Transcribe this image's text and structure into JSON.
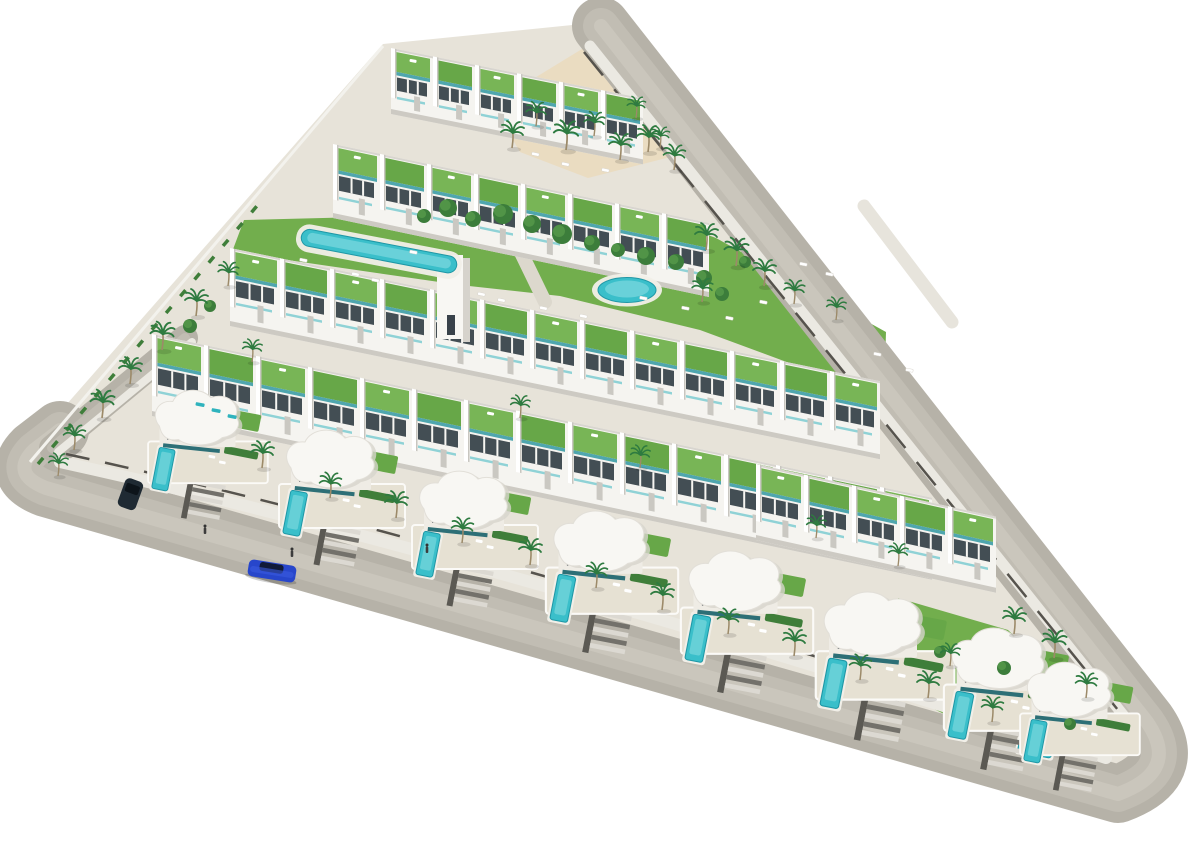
{
  "meta": {
    "width": 1204,
    "height": 853,
    "view": "aerial-3d-render-residential-development"
  },
  "palette": {
    "bg": "#ffffff",
    "ground": "#e7e3d9",
    "road": "#b6b2a8",
    "roadLight": "#c1bdb3",
    "roadLighter": "#cac6bc",
    "sidewalk": "#ebe9e2",
    "curb": "#56534d",
    "lawn": "#72ae4d",
    "lawnDark": "#5d9a40",
    "sand": "#eadcc1",
    "bldg": "#f5f4f0",
    "bldgShade": "#d8d5cf",
    "bldgShadow": "#cdcac3",
    "roofA": "#67a748",
    "roofB": "#78b556",
    "teal": "#4fa6ae",
    "tealLight": "#8fd2d6",
    "window": "#434e54",
    "pool": "#3abfca",
    "poolLight": "#79d7dd",
    "poolDark": "#1f97a6",
    "deck": "#f1efe8",
    "hedge": "#3f7e3a",
    "palm": "#2e7b40",
    "trunk": "#9c8a69",
    "pergola": "#4a5146",
    "person": "#333333"
  },
  "site": {
    "ground": [
      [
        383,
        44
      ],
      [
        602,
        22
      ],
      [
        1168,
        738
      ],
      [
        1150,
        788
      ],
      [
        1104,
        806
      ],
      [
        40,
        500
      ],
      [
        16,
        462
      ]
    ],
    "left_wall": {
      "x1": 30,
      "y1": 462,
      "x2": 383,
      "y2": 46
    },
    "left_hedge": {
      "x1": 38,
      "y1": 464,
      "x2": 262,
      "y2": 200
    }
  },
  "sand": [
    [
      492,
      104
    ],
    [
      600,
      38
    ],
    [
      690,
      152
    ],
    [
      588,
      178
    ],
    [
      520,
      152
    ]
  ],
  "lawns": [
    [
      [
        244,
        220
      ],
      [
        640,
        210
      ],
      [
        716,
        238
      ],
      [
        886,
        332
      ],
      [
        884,
        398
      ],
      [
        700,
        330
      ],
      [
        560,
        296
      ],
      [
        460,
        285
      ],
      [
        232,
        252
      ]
    ],
    [
      [
        898,
        598
      ],
      [
        1008,
        630
      ],
      [
        1102,
        722
      ],
      [
        1044,
        764
      ],
      [
        916,
        700
      ]
    ]
  ],
  "lawn_patches": [
    [
      [
        420,
        215
      ],
      [
        560,
        230
      ],
      [
        640,
        262
      ],
      [
        560,
        260
      ],
      [
        470,
        240
      ]
    ]
  ],
  "walkways": [
    {
      "x1": 513,
      "y1": 236,
      "x2": 545,
      "y2": 302,
      "w": 14,
      "color": "#dcd8cd"
    },
    {
      "x1": 864,
      "y1": 206,
      "x2": 952,
      "y2": 322,
      "w": 13,
      "color": "#e7e4dc"
    },
    {
      "x1": 622,
      "y1": 92,
      "x2": 702,
      "y2": 190,
      "w": 11,
      "color": "#4a5146"
    }
  ],
  "roads": {
    "main": {
      "d": "M 601,26 L 1147,722 Q 1181,771 1118,794 L 46,488 Q 10,474 34,450 L 60,430",
      "w": 58
    },
    "stub": {
      "d": "M 52,448 L 185,338",
      "w": 26
    },
    "streaks": [
      36,
      14
    ],
    "sidewalks": [
      {
        "d": "M 60,462 C 360,528 730,636 1106,758",
        "w": 12
      },
      {
        "d": "M 590,46 L 1124,716",
        "w": 11
      },
      {
        "d": "M 58,452 L 192,342",
        "w": 8
      }
    ],
    "curbs": [
      {
        "d": "M 66,454 C 360,518 730,626 1098,746",
        "dash": "24 16"
      },
      {
        "d": "M 584,52 L 1118,710",
        "dash": "30 18"
      }
    ]
  },
  "bands": [
    {
      "x": 391,
      "y": 48,
      "units": 6,
      "uw": 42,
      "slope": 0.2,
      "depth": 66
    },
    {
      "x": 333,
      "y": 144,
      "units": 8,
      "uw": 47,
      "slope": 0.21,
      "depth": 74
    },
    {
      "x": 230,
      "y": 248,
      "units": 13,
      "uw": 50,
      "slope": 0.205,
      "depth": 78
    },
    {
      "x": 152,
      "y": 334,
      "units": 15,
      "uw": 52,
      "slope": 0.21,
      "depth": 82
    },
    {
      "x": 756,
      "y": 464,
      "units": 5,
      "uw": 48,
      "slope": 0.22,
      "depth": 76
    }
  ],
  "tower": {
    "x": 437,
    "y": 255,
    "w": 26,
    "h": 84
  },
  "pools": {
    "main": {
      "x": 303,
      "y": 228,
      "rot": 10.8,
      "w": 158,
      "h": 17
    },
    "round": {
      "cx": 627,
      "cy": 290,
      "rx": 29,
      "ry": 12.5
    },
    "corner": {
      "x": 1020,
      "y": 738,
      "rot": 11,
      "w": 34,
      "h": 14
    }
  },
  "villas": [
    [
      150,
      392,
      0.95
    ],
    [
      281,
      432,
      1
    ],
    [
      414,
      473,
      1
    ],
    [
      548,
      513,
      1.05
    ],
    [
      683,
      553,
      1.05
    ],
    [
      818,
      594,
      1.1
    ],
    [
      946,
      630,
      1.05
    ],
    [
      1022,
      664,
      0.95
    ]
  ],
  "palms": [
    [
      512,
      148,
      1
    ],
    [
      536,
      126,
      0.9
    ],
    [
      566,
      150,
      1.1
    ],
    [
      594,
      136,
      0.9
    ],
    [
      620,
      160,
      1
    ],
    [
      648,
      152,
      1
    ],
    [
      674,
      170,
      0.95
    ],
    [
      706,
      250,
      1
    ],
    [
      736,
      266,
      1.05
    ],
    [
      764,
      286,
      1
    ],
    [
      794,
      304,
      0.9
    ],
    [
      702,
      302,
      0.9
    ],
    [
      836,
      320,
      0.85
    ],
    [
      196,
      316,
      1
    ],
    [
      162,
      350,
      1.05
    ],
    [
      130,
      384,
      1
    ],
    [
      102,
      418,
      1.05
    ],
    [
      74,
      450,
      0.95
    ],
    [
      58,
      476,
      0.85
    ],
    [
      228,
      286,
      0.9
    ],
    [
      252,
      362,
      0.85
    ],
    [
      520,
      418,
      0.85
    ],
    [
      640,
      468,
      0.85
    ],
    [
      816,
      538,
      0.85
    ],
    [
      898,
      566,
      0.85
    ],
    [
      262,
      468,
      1
    ],
    [
      330,
      498,
      0.95
    ],
    [
      396,
      518,
      1
    ],
    [
      462,
      543,
      0.95
    ],
    [
      530,
      565,
      1
    ],
    [
      596,
      588,
      0.95
    ],
    [
      662,
      610,
      1
    ],
    [
      728,
      634,
      0.95
    ],
    [
      794,
      656,
      1
    ],
    [
      860,
      680,
      0.95
    ],
    [
      928,
      698,
      1
    ],
    [
      992,
      722,
      0.95
    ],
    [
      1014,
      634,
      1
    ],
    [
      1054,
      658,
      1.05
    ],
    [
      1086,
      698,
      0.95
    ],
    [
      950,
      666,
      0.85
    ],
    [
      636,
      118,
      0.8
    ],
    [
      660,
      148,
      0.8
    ]
  ],
  "bushes": [
    [
      424,
      216,
      7
    ],
    [
      448,
      208,
      9
    ],
    [
      473,
      219,
      8
    ],
    [
      503,
      214,
      10
    ],
    [
      532,
      224,
      9
    ],
    [
      562,
      234,
      10
    ],
    [
      592,
      243,
      8
    ],
    [
      618,
      250,
      7
    ],
    [
      646,
      256,
      9
    ],
    [
      676,
      262,
      8
    ],
    [
      704,
      278,
      8
    ],
    [
      722,
      294,
      7
    ],
    [
      745,
      262,
      6
    ],
    [
      210,
      306,
      6
    ],
    [
      190,
      326,
      7
    ],
    [
      940,
      652,
      6
    ],
    [
      1004,
      668,
      7
    ],
    [
      1070,
      724,
      6
    ]
  ],
  "loungers": {
    "white": [
      [
        352,
        272
      ],
      [
        372,
        278
      ],
      [
        478,
        292
      ],
      [
        498,
        298
      ],
      [
        540,
        306
      ],
      [
        580,
        314
      ],
      [
        640,
        296
      ],
      [
        682,
        306
      ],
      [
        726,
        316
      ],
      [
        760,
        300
      ],
      [
        800,
        262
      ],
      [
        826,
        272
      ],
      [
        532,
        152
      ],
      [
        562,
        162
      ],
      [
        602,
        168
      ],
      [
        410,
        250
      ],
      [
        300,
        258
      ],
      [
        874,
        352
      ],
      [
        906,
        368
      ]
    ],
    "teal": [
      [
        196,
        402
      ],
      [
        212,
        408
      ],
      [
        228,
        414
      ]
    ]
  },
  "vehicles": {
    "sedan": {
      "x": 272,
      "y": 571,
      "rot": 9,
      "body": "#2746cb",
      "glass": "#101a38"
    },
    "suv": {
      "x": 130,
      "y": 494,
      "rot": 20,
      "body": "#1f2a33",
      "glass": "#0d141a"
    }
  },
  "people": [
    [
      205,
      532
    ],
    [
      292,
      555
    ],
    [
      427,
      551
    ]
  ]
}
